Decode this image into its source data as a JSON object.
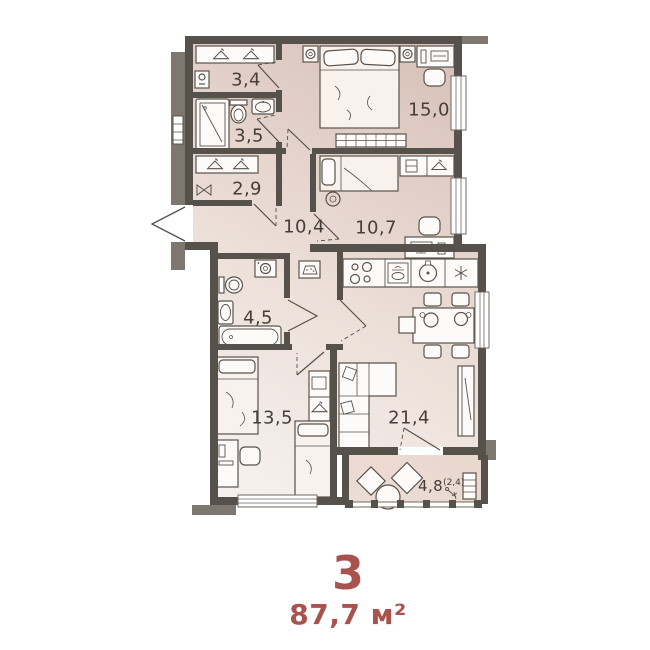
{
  "summary": {
    "rooms_count": "3",
    "total_area": "87,7 м²"
  },
  "rooms": {
    "dressing": {
      "label": "3,4"
    },
    "shower": {
      "label": "3,5"
    },
    "closet": {
      "label": "2,9"
    },
    "hall": {
      "label": "10,4"
    },
    "bedroom2": {
      "label": "10,7"
    },
    "bedroom1": {
      "label": "15,0"
    },
    "bathroom": {
      "label": "4,5"
    },
    "kids": {
      "label": "13,5"
    },
    "living": {
      "label": "21,4"
    },
    "balcony": {
      "label": "4,8",
      "note": "(2,4)"
    }
  },
  "colors": {
    "wall": "#57514b",
    "adjacent_gray": "#7d776f",
    "floor_light": "#f7f2ef",
    "floor_dark": "#d6bfb6",
    "balcony_floor": "#e4cbbb",
    "accent_text": "#a9534f",
    "label_text": "#473e39"
  }
}
